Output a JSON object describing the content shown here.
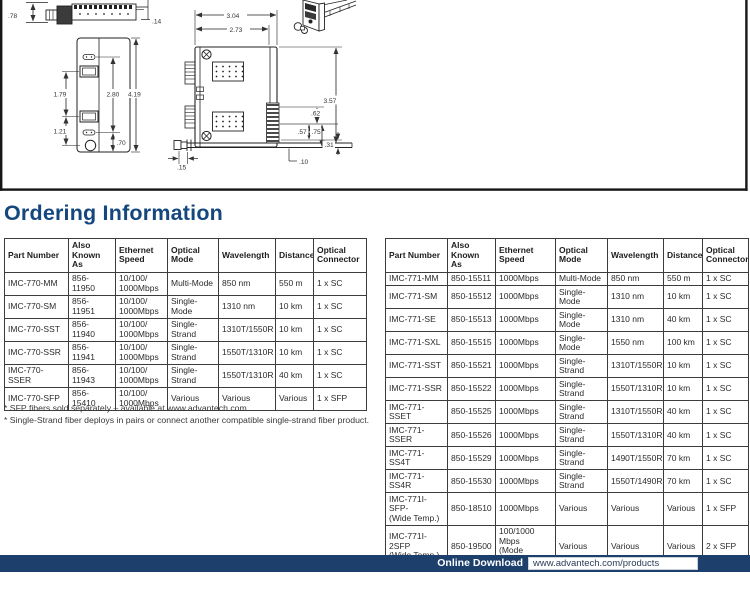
{
  "heading": "Ordering Information",
  "drawing": {
    "dims": {
      "v78": ".78",
      "v14": ".14",
      "v179": "1.79",
      "v280": "2.80",
      "v419": "4.19",
      "v121": "1.21",
      "v70": ".70",
      "v304": "3.04",
      "v273": "2.73",
      "v357": "3.57",
      "v62": ".62",
      "v57": ".57",
      "v75": ".75",
      "v31": ".31",
      "v15": ".15",
      "v10": ".10"
    }
  },
  "tables": {
    "left": {
      "headers": [
        "Part Number",
        "Also\nKnown As",
        "Ethernet\nSpeed",
        "Optical\nMode",
        "Wavelength",
        "Distance",
        "Optical\nConnector"
      ],
      "rows": [
        [
          "IMC-770-MM",
          "856-11950",
          "10/100/\n1000Mbps",
          "Multi-Mode",
          "850 nm",
          "550 m",
          "1 x SC"
        ],
        [
          "IMC-770-SM",
          "856-11951",
          "10/100/\n1000Mbps",
          "Single-Mode",
          "1310 nm",
          "10 km",
          "1 x SC"
        ],
        [
          "IMC-770-SST",
          "856-11940",
          "10/100/\n1000Mbps",
          "Single-Strand",
          "1310T/1550R",
          "10 km",
          "1 x SC"
        ],
        [
          "IMC-770-SSR",
          "856-11941",
          "10/100/\n1000Mbps",
          "Single-Strand",
          "1550T/1310R",
          "10 km",
          "1 x SC"
        ],
        [
          "IMC-770-SSER",
          "856-11943",
          "10/100/\n1000Mbps",
          "Single-Strand",
          "1550T/1310R",
          "40 km",
          "1 x SC"
        ],
        [
          "IMC-770-SFP",
          "856-15410",
          "10/100/\n1000Mbps",
          "Various",
          "Various",
          "Various",
          "1 x SFP"
        ]
      ]
    },
    "right": {
      "headers": [
        "Part Number",
        "Also\nKnown As",
        "Ethernet\nSpeed",
        "Optical\nMode",
        "Wavelength",
        "Distance",
        "Optical\nConnector"
      ],
      "rows": [
        [
          "IMC-771-MM",
          "850-15511",
          "1000Mbps",
          "Multi-Mode",
          "850 nm",
          "550 m",
          "1 x SC"
        ],
        [
          "IMC-771-SM",
          "850-15512",
          "1000Mbps",
          "Single-Mode",
          "1310 nm",
          "10 km",
          "1 x SC"
        ],
        [
          "IMC-771-SE",
          "850-15513",
          "1000Mbps",
          "Single-Mode",
          "1310 nm",
          "40 km",
          "1 x SC"
        ],
        [
          "IMC-771-SXL",
          "850-15515",
          "1000Mbps",
          "Single-Mode",
          "1550 nm",
          "100 km",
          "1 x SC"
        ],
        [
          "IMC-771-SST",
          "850-15521",
          "1000Mbps",
          "Single-Strand",
          "1310T/1550R",
          "10 km",
          "1 x SC"
        ],
        [
          "IMC-771-SSR",
          "850-15522",
          "1000Mbps",
          "Single-Strand",
          "1550T/1310R",
          "10 km",
          "1 x SC"
        ],
        [
          "IMC-771-SSET",
          "850-15525",
          "1000Mbps",
          "Single-Strand",
          "1310T/1550R",
          "40 km",
          "1 x SC"
        ],
        [
          "IMC-771-SSER",
          "850-15526",
          "1000Mbps",
          "Single-Strand",
          "1550T/1310R",
          "40 km",
          "1 x SC"
        ],
        [
          "IMC-771-SS4T",
          "850-15529",
          "1000Mbps",
          "Single-Strand",
          "1490T/1550R",
          "70 km",
          "1 x SC"
        ],
        [
          "IMC-771-SS4R",
          "850-15530",
          "1000Mbps",
          "Single-Strand",
          "1550T/1490R",
          "70 km",
          "1 x SC"
        ],
        [
          "IMC-771I-SFP-\n(Wide Temp.)",
          "850-18510",
          "1000Mbps",
          "Various",
          "Various",
          "Various",
          "1 x SFP"
        ],
        [
          "IMC-771I-2SFP\n(Wide Temp.)",
          "850-19500",
          "100/1000 Mbps\n(Mode\nconverter)",
          "Various",
          "Various",
          "Various",
          "2 x SFP"
        ]
      ]
    }
  },
  "footnotes": [
    "* SFP fibers sold separately – available at www.advantech.com",
    "* Single-Strand fiber deploys in pairs or connect another compatible single-strand fiber product."
  ],
  "footer": {
    "label": "Online Download",
    "url": "www.advantech.com/products"
  },
  "colors": {
    "heading": "#14477d",
    "footer_bar": "#1d3f6c"
  }
}
